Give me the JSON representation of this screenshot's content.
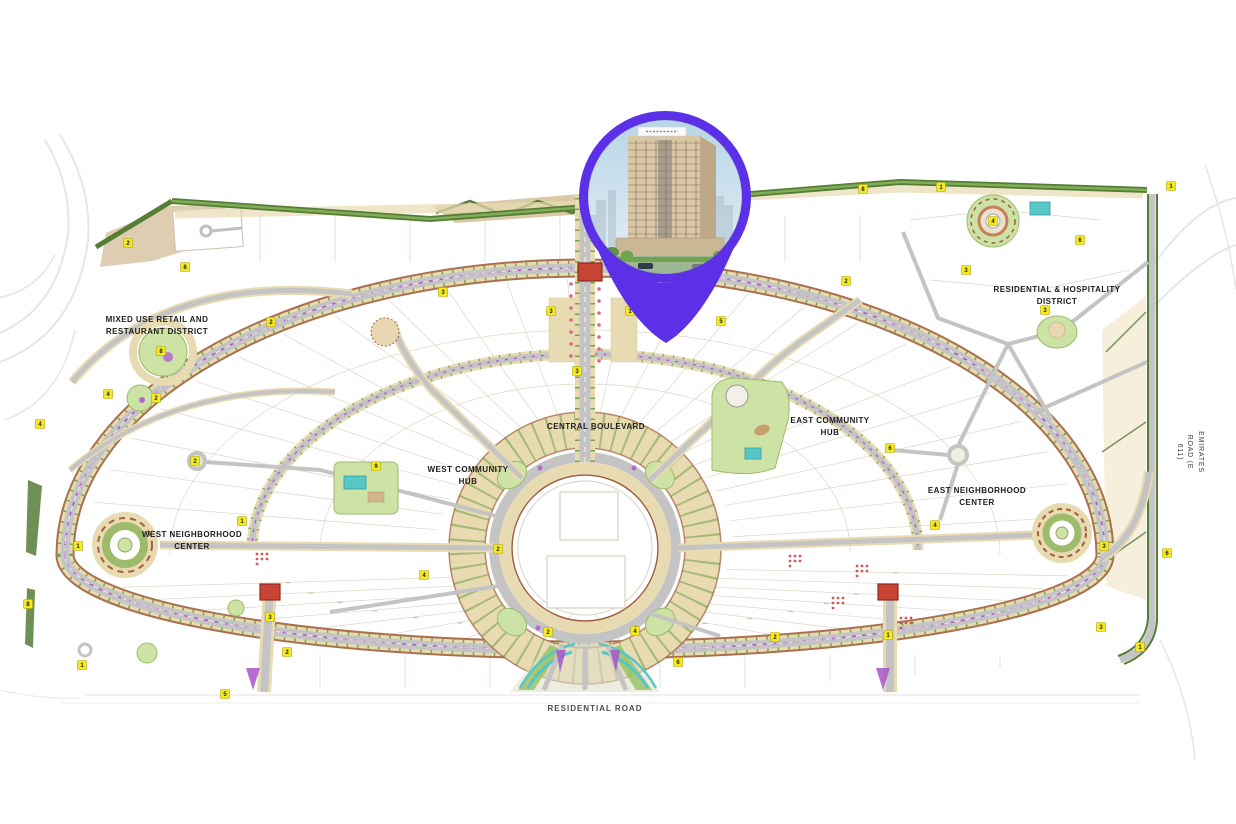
{
  "map": {
    "type": "community-master-plan",
    "labels": {
      "mixed_use_district": "MIXED USE RETAIL AND\nRESTAURANT DISTRICT",
      "central_boulevard": "CENTRAL BOULEVARD",
      "west_community_hub": "WEST COMMUNITY\nHUB",
      "east_community_hub": "EAST COMMUNITY\nHUB",
      "west_neighborhood_center": "WEST NEIGHBORHOOD\nCENTER",
      "east_neighborhood_center": "EAST NEIGHBORHOOD\nCENTER",
      "residential_hospitality_district": "RESIDENTIAL & HOSPITALITY\nDISTRICT",
      "residential_road": "RESIDENTIAL ROAD",
      "emirates_road": "EMIRATES ROAD (E 611)"
    },
    "markers": [
      {
        "n": "2",
        "x": 128,
        "y": 243
      },
      {
        "n": "8",
        "x": 185,
        "y": 267
      },
      {
        "n": "2",
        "x": 271,
        "y": 322
      },
      {
        "n": "8",
        "x": 161,
        "y": 351
      },
      {
        "n": "4",
        "x": 108,
        "y": 394
      },
      {
        "n": "2",
        "x": 156,
        "y": 398
      },
      {
        "n": "4",
        "x": 40,
        "y": 424
      },
      {
        "n": "1",
        "x": 78,
        "y": 546
      },
      {
        "n": "2",
        "x": 195,
        "y": 461
      },
      {
        "n": "1",
        "x": 242,
        "y": 521
      },
      {
        "n": "8",
        "x": 28,
        "y": 604
      },
      {
        "n": "1",
        "x": 82,
        "y": 665
      },
      {
        "n": "5",
        "x": 225,
        "y": 694
      },
      {
        "n": "2",
        "x": 287,
        "y": 652
      },
      {
        "n": "3",
        "x": 270,
        "y": 617
      },
      {
        "n": "3",
        "x": 443,
        "y": 292
      },
      {
        "n": "3",
        "x": 551,
        "y": 311
      },
      {
        "n": "1",
        "x": 630,
        "y": 311
      },
      {
        "n": "5",
        "x": 721,
        "y": 321
      },
      {
        "n": "3",
        "x": 577,
        "y": 371
      },
      {
        "n": "9",
        "x": 376,
        "y": 466
      },
      {
        "n": "2",
        "x": 498,
        "y": 549
      },
      {
        "n": "4",
        "x": 424,
        "y": 575
      },
      {
        "n": "2",
        "x": 548,
        "y": 632
      },
      {
        "n": "4",
        "x": 635,
        "y": 631
      },
      {
        "n": "6",
        "x": 678,
        "y": 662
      },
      {
        "n": "2",
        "x": 775,
        "y": 637
      },
      {
        "n": "2",
        "x": 846,
        "y": 281
      },
      {
        "n": "8",
        "x": 863,
        "y": 189
      },
      {
        "n": "1",
        "x": 941,
        "y": 187
      },
      {
        "n": "3",
        "x": 966,
        "y": 270
      },
      {
        "n": "3",
        "x": 1045,
        "y": 310
      },
      {
        "n": "6",
        "x": 1080,
        "y": 240
      },
      {
        "n": "1",
        "x": 1171,
        "y": 186
      },
      {
        "n": "6",
        "x": 890,
        "y": 448
      },
      {
        "n": "4",
        "x": 935,
        "y": 525
      },
      {
        "n": "3",
        "x": 1104,
        "y": 546
      },
      {
        "n": "6",
        "x": 1167,
        "y": 553
      },
      {
        "n": "3",
        "x": 1101,
        "y": 627
      },
      {
        "n": "1",
        "x": 1140,
        "y": 647
      },
      {
        "n": "1",
        "x": 888,
        "y": 635
      },
      {
        "n": "4",
        "x": 993,
        "y": 221
      }
    ],
    "colors": {
      "pin": "#5B30E6",
      "road": "#c4c4c4",
      "tan": "#e8dbb2",
      "maroon": "#a0603d",
      "park": "#cde3a6",
      "hedge": "#567d36",
      "pool": "#58c7c8",
      "marker": "#f5e921",
      "redbox": "#c74334",
      "median": "#b052cf",
      "hatch": "#7aa24e"
    },
    "pin": {
      "icon": "location-pin",
      "photo": "residential-tower-photo"
    }
  }
}
